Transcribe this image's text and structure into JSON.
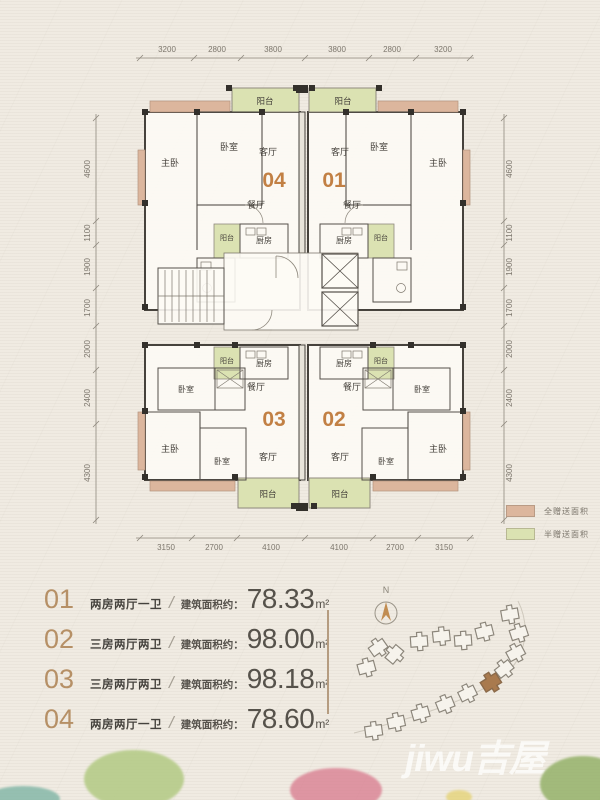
{
  "plan": {
    "dims": {
      "top": [
        "3200",
        "2800",
        "3800",
        "3800",
        "2800",
        "3200"
      ],
      "bottom": [
        "3150",
        "2700",
        "4100",
        "4100",
        "2700",
        "3150"
      ],
      "left": [
        "4600",
        "1100",
        "1900",
        "1700",
        "2000",
        "2400",
        "4300"
      ],
      "right": [
        "4600",
        "1100",
        "1900",
        "1700",
        "2000",
        "2400",
        "4300"
      ]
    },
    "rooms": {
      "balcony": "阳台",
      "master_bedroom": "主卧",
      "bedroom": "卧室",
      "living_room": "客厅",
      "dining_room": "餐厅",
      "kitchen": "厨房"
    },
    "units": {
      "top_left": "04",
      "top_right": "01",
      "bottom_left": "03",
      "bottom_right": "02"
    },
    "accent_colors": {
      "full_gift": "#dcb69d",
      "half_gift": "#dbe2b2",
      "unit_number": "#c28044"
    }
  },
  "legend": {
    "items": [
      {
        "label": "全赠送面积",
        "color": "#dcb69d"
      },
      {
        "label": "半赠送面积",
        "color": "#dbe2b2"
      }
    ]
  },
  "unit_list": {
    "separator": "/",
    "area_prefix": "建筑面积约：",
    "rows": [
      {
        "no": "01",
        "type": "两房两厅一卫",
        "area": "78.33",
        "unit": "m²"
      },
      {
        "no": "02",
        "type": "三房两厅两卫",
        "area": "98.00",
        "unit": "m²"
      },
      {
        "no": "03",
        "type": "三房两厅两卫",
        "area": "98.18",
        "unit": "m²"
      },
      {
        "no": "04",
        "type": "两房两厅一卫",
        "area": "78.60",
        "unit": "m²"
      }
    ]
  },
  "compass": {
    "label": "N"
  },
  "watermark": {
    "text": "jiwu吉屋"
  }
}
